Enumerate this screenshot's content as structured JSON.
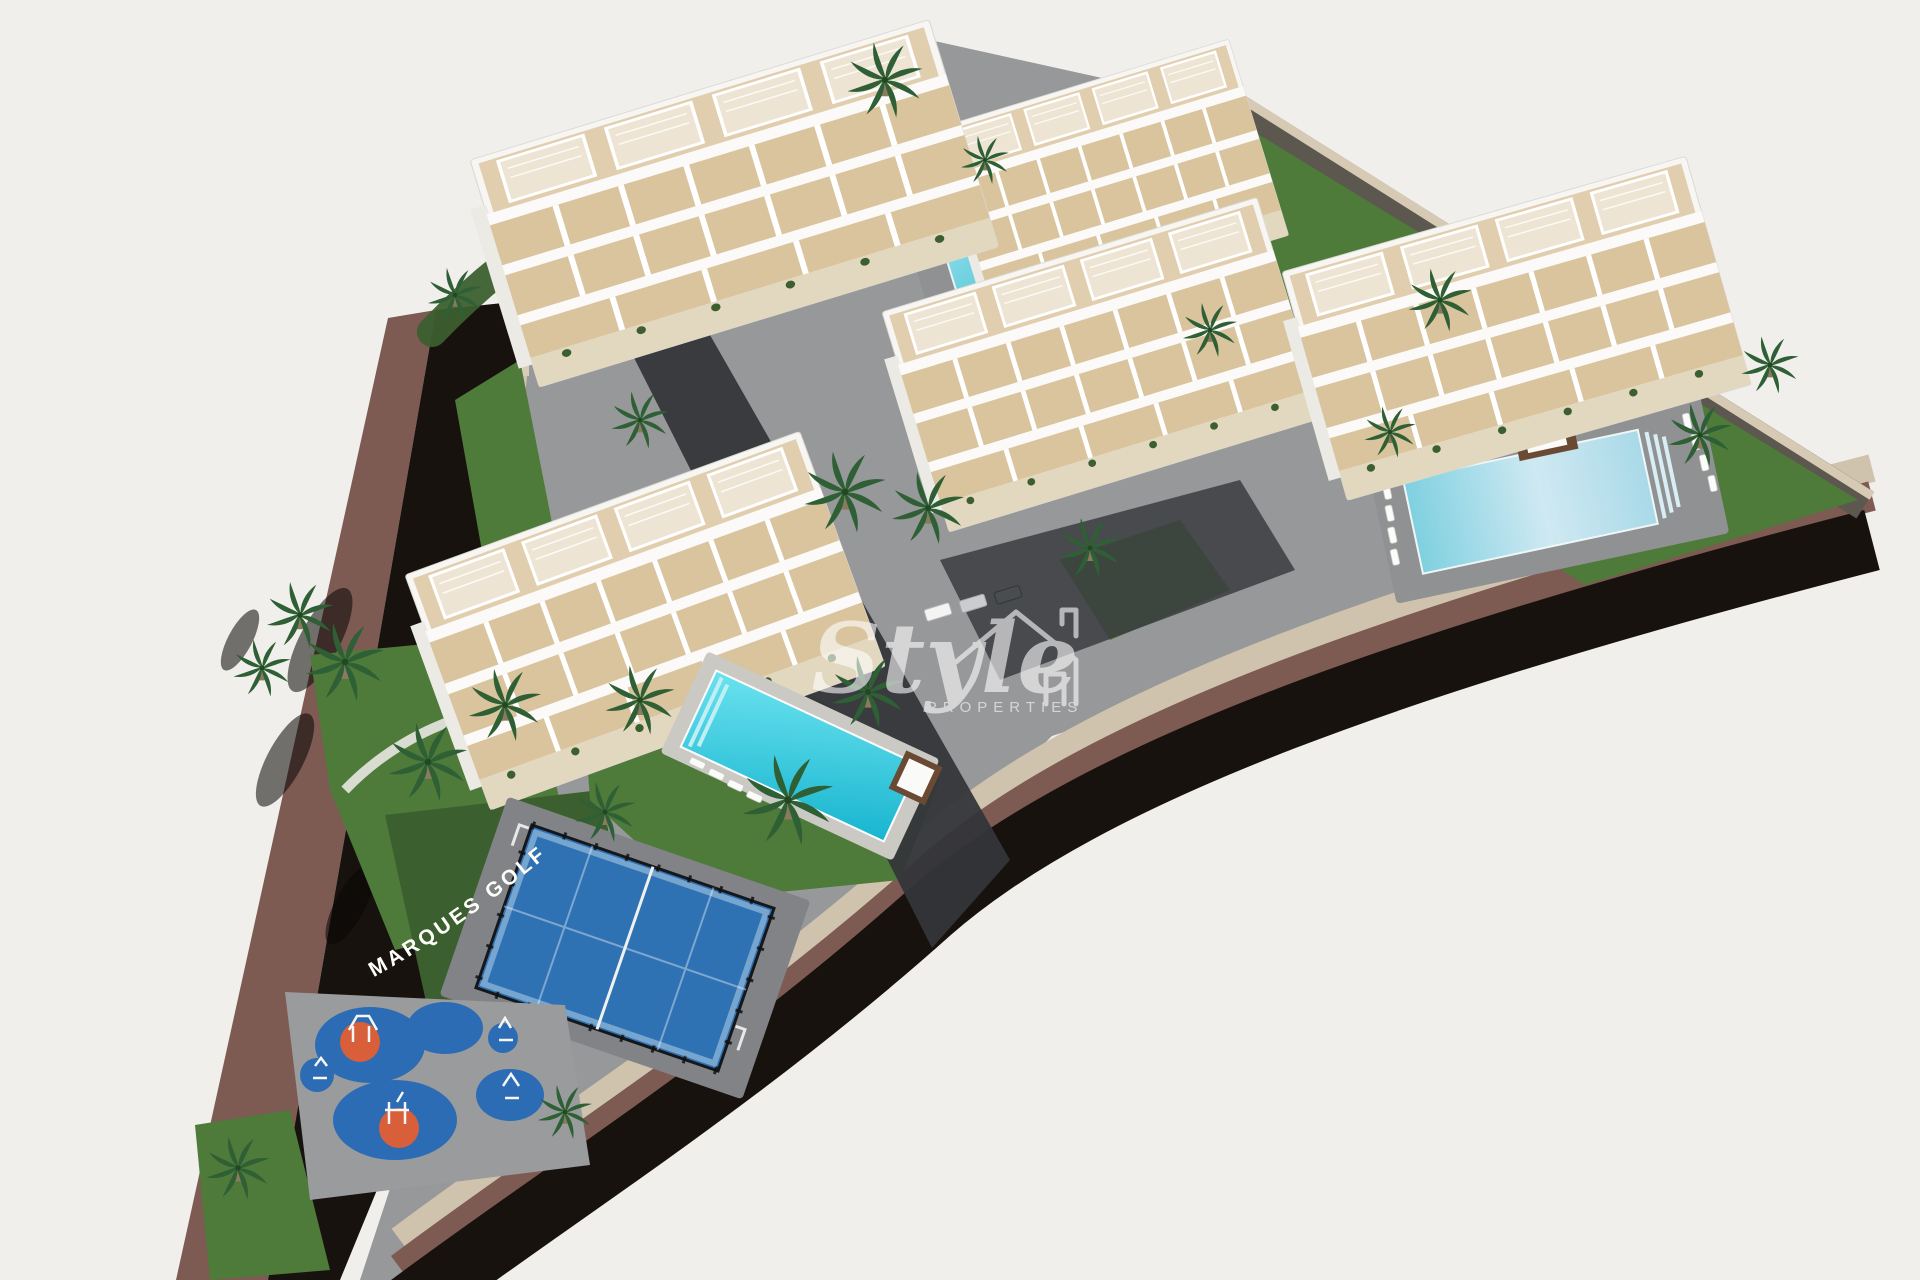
{
  "scene": {
    "description": "Aerial 3D architectural rendering of a residential complex: five white terraced apartment buildings, three swimming pools, a padel court, a playground with blue rubber zones, palm-lined lawns, and a dark asphalt road with a maroon sidewalk wrapping the site; off-white background.",
    "sign_text": "MARQUES GOLF",
    "watermark": {
      "name": "Style",
      "subtitle": "PROPERTIES",
      "icon": "house-outline-icon"
    },
    "features": {
      "apartment_buildings": 5,
      "swimming_pools": 3,
      "padel_courts": 1,
      "playgrounds": 1
    },
    "colors": {
      "background": "#f1efec",
      "road_asphalt": "#17120e",
      "sidewalk_maroon": "#7d5a52",
      "curb_beige": "#cfc3ad",
      "stone_wall": "#5c574f",
      "wall_cap": "#d6cab4",
      "pavement": "#97989a",
      "deck_gray": "#8f9193",
      "drive_dark": "#34363a",
      "grass": "#4e7b3a",
      "grass_dark": "#3c5f2f",
      "palm": "#2f5f35",
      "pool_turquoise": "#2fc5da",
      "pool_pale": "#9fd3e6",
      "padel_blue": "#2f72b4",
      "play_blue": "#2b6cb4",
      "play_orange": "#d95f3b",
      "building_white": "#f7f6f3",
      "ledge_white": "#fbfaf8",
      "terrace_sand": "#d9c49e",
      "base_stone": "#e2d7bf",
      "wood_brown": "#6b4a33",
      "watermark": "#ffffff"
    }
  }
}
